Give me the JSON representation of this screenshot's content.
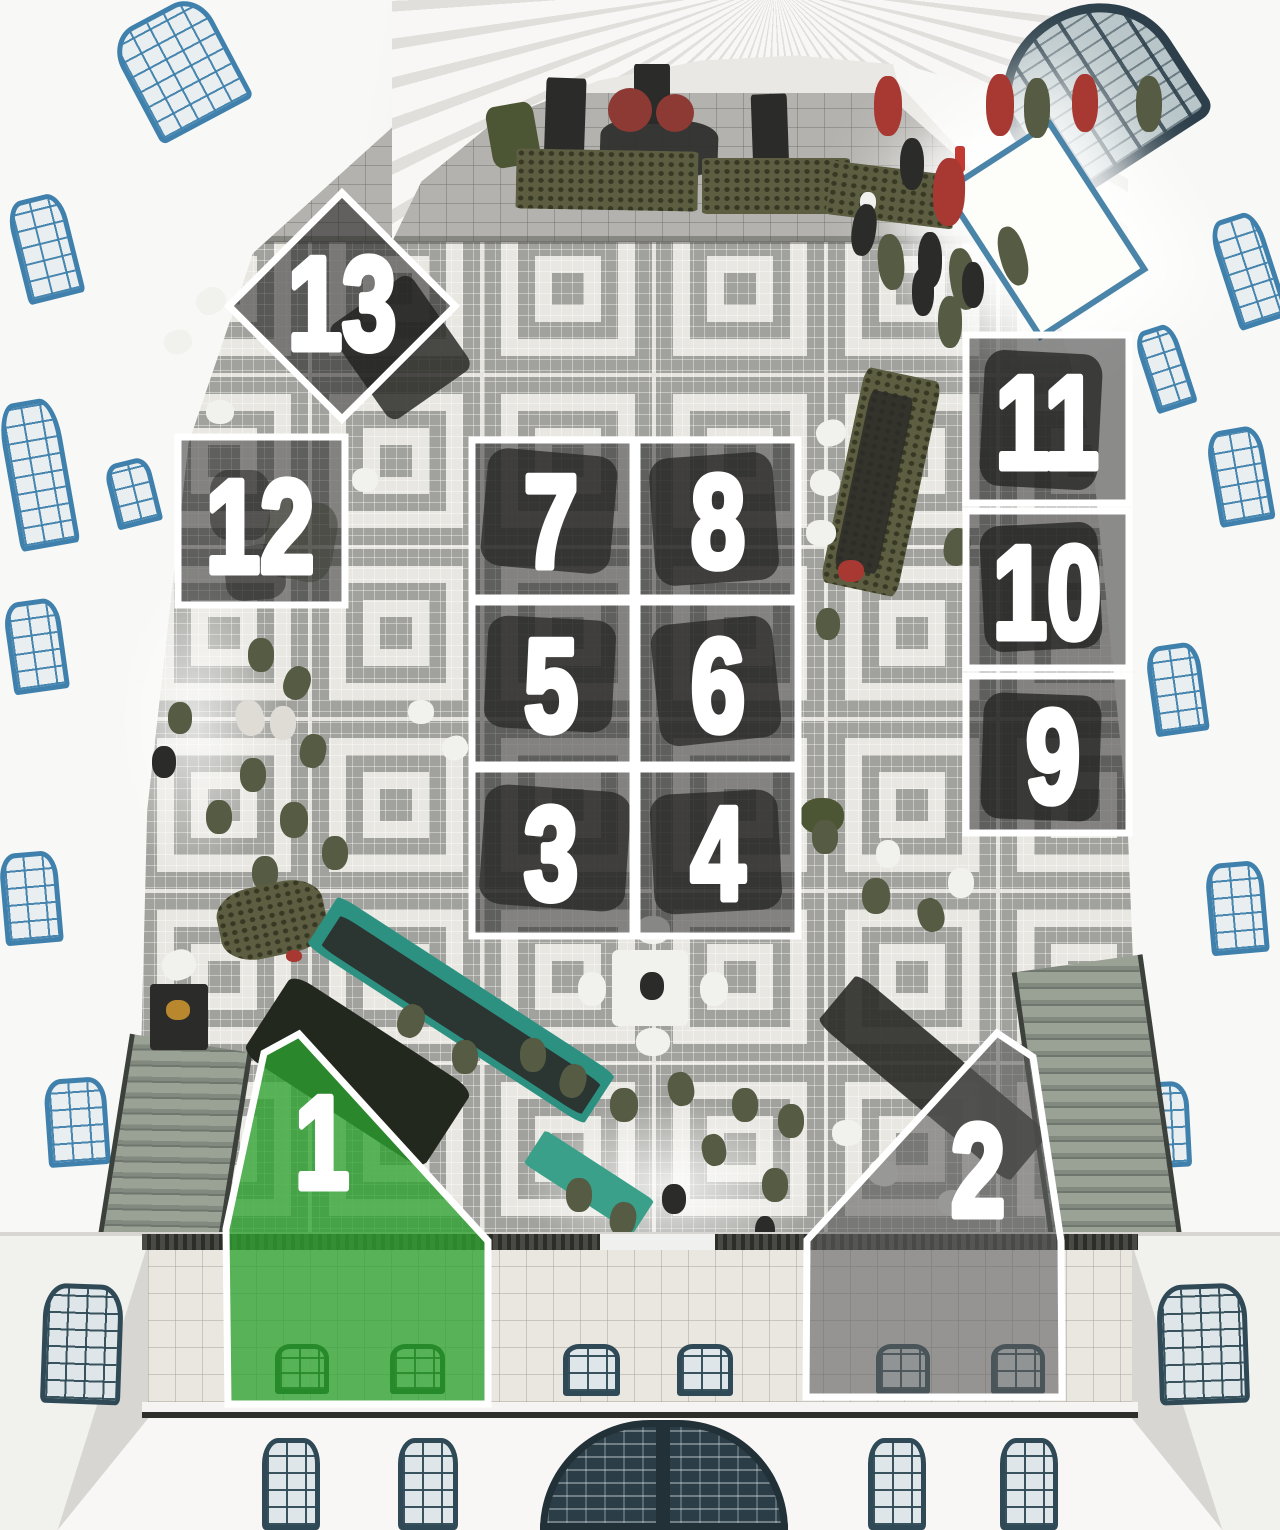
{
  "zones": {
    "border_color": "#ffffff",
    "highlight_fill": "#2ea32f",
    "secondary_fill": "#5d5d5d",
    "overlay_fill": "#1d1d1d",
    "items": [
      {
        "id": 1,
        "label": "1",
        "style": "highlight"
      },
      {
        "id": 2,
        "label": "2",
        "style": "secondary"
      },
      {
        "id": 3,
        "label": "3",
        "style": "overlay"
      },
      {
        "id": 4,
        "label": "4",
        "style": "overlay"
      },
      {
        "id": 5,
        "label": "5",
        "style": "overlay"
      },
      {
        "id": 6,
        "label": "6",
        "style": "overlay"
      },
      {
        "id": 7,
        "label": "7",
        "style": "overlay"
      },
      {
        "id": 8,
        "label": "8",
        "style": "overlay"
      },
      {
        "id": 9,
        "label": "9",
        "style": "overlay"
      },
      {
        "id": 10,
        "label": "10",
        "style": "overlay"
      },
      {
        "id": 11,
        "label": "11",
        "style": "overlay"
      },
      {
        "id": 12,
        "label": "12",
        "style": "overlay"
      },
      {
        "id": 13,
        "label": "13",
        "style": "overlay"
      }
    ]
  }
}
